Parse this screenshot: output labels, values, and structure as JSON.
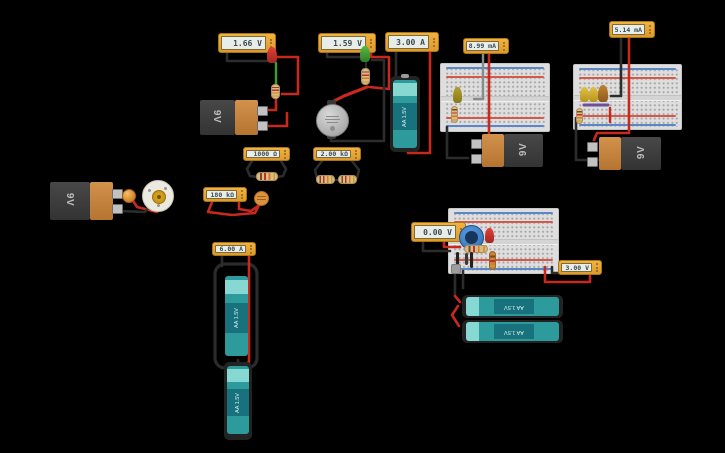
{
  "canvas": {
    "width": 725,
    "height": 453,
    "background": "#000000"
  },
  "meters": [
    {
      "name": "voltmeter-red-led",
      "reading": "1.66 V"
    },
    {
      "name": "voltmeter-green-led",
      "reading": "1.59 V"
    },
    {
      "name": "ammeter-aa-battery",
      "reading": "3.00 A"
    },
    {
      "name": "ammeter-breadboard-1",
      "reading": "8.99 mA"
    },
    {
      "name": "ammeter-breadboard-2",
      "reading": "5.14 mA"
    },
    {
      "name": "ohmmeter-single-resistor",
      "reading": "1000 Ω"
    },
    {
      "name": "ohmmeter-series-resistors",
      "reading": "2.00 kΩ"
    },
    {
      "name": "ohmmeter-photoresistor",
      "reading": "180 kΩ"
    },
    {
      "name": "ammeter-aa-pair",
      "reading": "6.00 A"
    },
    {
      "name": "voltmeter-potentiometer",
      "reading": "0.00 V"
    },
    {
      "name": "voltmeter-battery-pack",
      "reading": "3.00 V"
    }
  ],
  "labels": {
    "nine_volt": "9V",
    "aa": "AA 1.5V"
  },
  "components": [
    "breadboard-small x3",
    "9v-battery x4",
    "aa-battery x5",
    "coin-cell",
    "dc-motor",
    "vibration-motor",
    "light-bulb",
    "photoresistor",
    "potentiometer",
    "led-red x2",
    "led-green",
    "led-yellow x2",
    "led-amber",
    "capacitor",
    "resistors"
  ],
  "colors": {
    "background": "#000000",
    "meter_body": "#E8A738",
    "meter_display": "#E9EDEA",
    "meter_text": "#3A4A52",
    "breadboard": "#DEDEDE",
    "battery_9v_dark": "#3E3E3E",
    "battery_9v_orange": "#C5853F",
    "battery_aa_teal": "#2D9B9B",
    "wire_red": "#C9291D",
    "wire_black": "#2C2C2C",
    "wire_green": "#3E9C31",
    "wire_gray": "#868D8F",
    "wire_purple": "#6E4F9B"
  }
}
